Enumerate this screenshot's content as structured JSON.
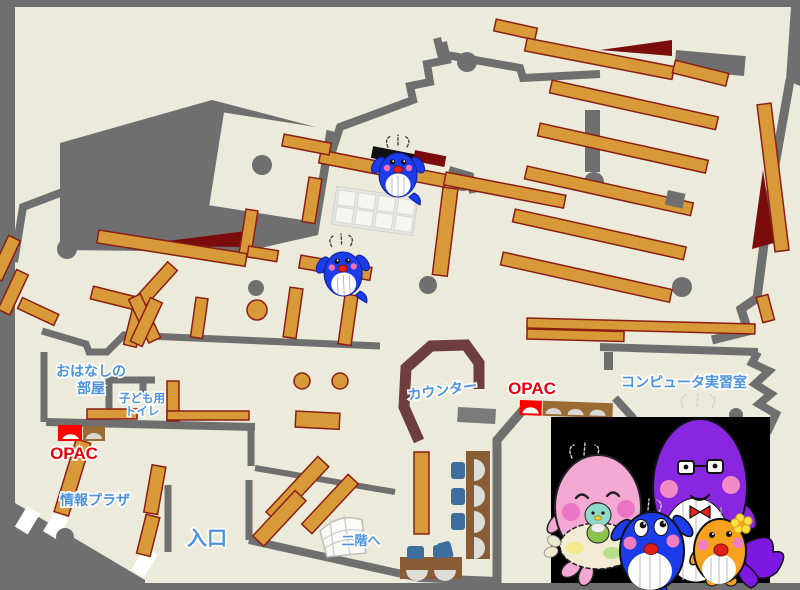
{
  "palette": {
    "floor": "#ECEBDB",
    "wall": "#6F6F6F",
    "shelf": "#D89A38",
    "shelf_border": "#8B1E14",
    "maroon": "#7B0C0C",
    "counter": "#6E3D3D",
    "label_blue": "#4C92DE",
    "label_red": "#E8000D",
    "chair_blue": "#3E6E9E",
    "bench_brown": "#8A5C36",
    "opac_brown": "#9A6B33",
    "panel_black": "#000000",
    "whale_blue": "#1C3CEA",
    "mascot_pink": "#F4A9D4",
    "mascot_purple": "#8826E0",
    "mascot_orange": "#F7A21E",
    "mascot_teal": "#8ED9C8"
  },
  "labels": {
    "ohanashi_line1": "おはなしの",
    "ohanashi_line2": "部屋",
    "toilet_line1": "子ども用",
    "toilet_line2": "トイレ",
    "opac_left": "OPAC",
    "opac_right": "OPAC",
    "info_plaza": "情報プラザ",
    "entrance": "入口",
    "counter": "カウンター",
    "stairs": "二階へ",
    "computer_room": "コンピュータ実習室"
  },
  "icons": {
    "map_mascots": [
      "blue-whale-mascot",
      "blue-whale-mascot"
    ],
    "panel_mascots": [
      "pink-whale-with-baby",
      "blue-whale-child",
      "purple-whale-with-glasses",
      "orange-fish"
    ]
  }
}
